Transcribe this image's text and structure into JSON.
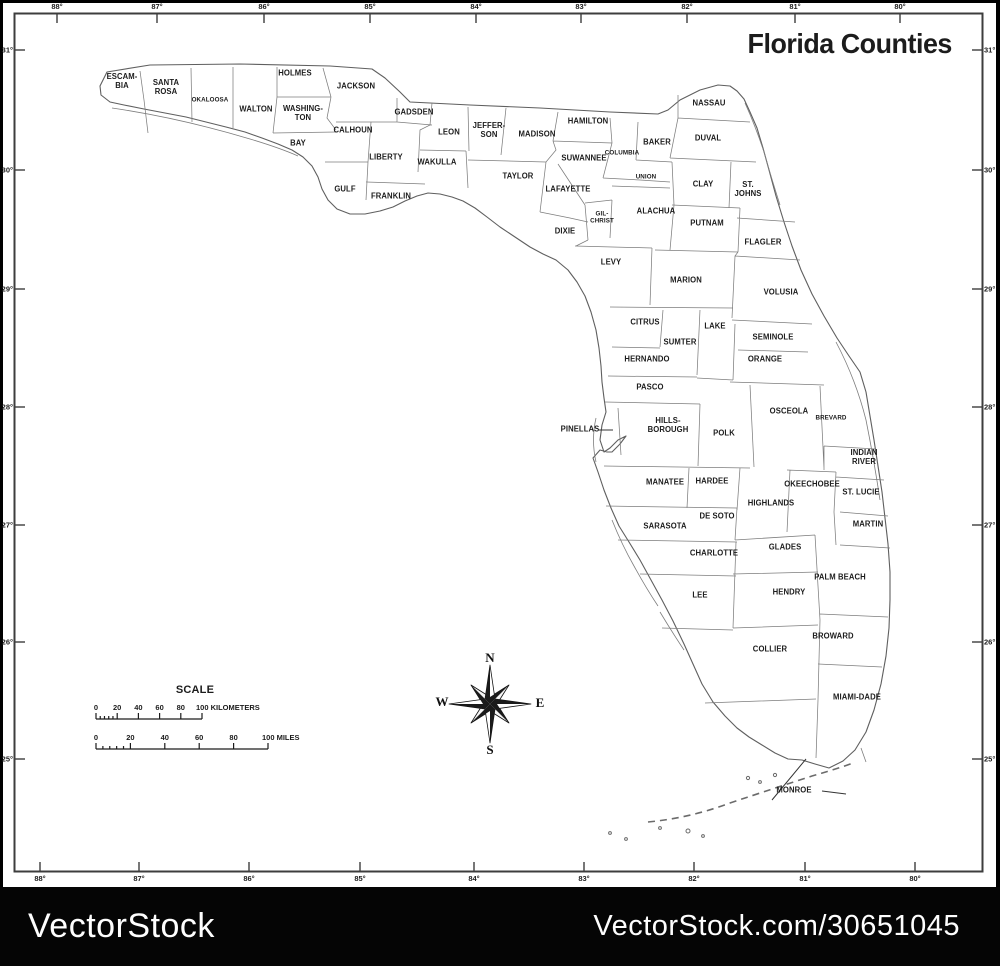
{
  "title": "Florida Counties",
  "map": {
    "counties": [
      {
        "name": "ESCAM-\nBIA",
        "x": 122,
        "y": 82
      },
      {
        "name": "SANTA\nROSA",
        "x": 166,
        "y": 88
      },
      {
        "name": "OKALOOSA",
        "x": 210,
        "y": 100,
        "small": true
      },
      {
        "name": "HOLMES",
        "x": 295,
        "y": 74
      },
      {
        "name": "WALTON",
        "x": 256,
        "y": 110
      },
      {
        "name": "WASHING-\nTON",
        "x": 303,
        "y": 114
      },
      {
        "name": "JACKSON",
        "x": 356,
        "y": 87
      },
      {
        "name": "BAY",
        "x": 298,
        "y": 144
      },
      {
        "name": "CALHOUN",
        "x": 353,
        "y": 131
      },
      {
        "name": "GADSDEN",
        "x": 414,
        "y": 113
      },
      {
        "name": "LIBERTY",
        "x": 386,
        "y": 158
      },
      {
        "name": "GULF",
        "x": 345,
        "y": 190
      },
      {
        "name": "FRANKLIN",
        "x": 391,
        "y": 197
      },
      {
        "name": "LEON",
        "x": 449,
        "y": 133
      },
      {
        "name": "JEFFER-\nSON",
        "x": 489,
        "y": 131
      },
      {
        "name": "WAKULLA",
        "x": 437,
        "y": 163
      },
      {
        "name": "MADISON",
        "x": 537,
        "y": 135
      },
      {
        "name": "TAYLOR",
        "x": 518,
        "y": 177
      },
      {
        "name": "LAFAYETTE",
        "x": 568,
        "y": 190
      },
      {
        "name": "HAMILTON",
        "x": 588,
        "y": 122
      },
      {
        "name": "SUWANNEE",
        "x": 584,
        "y": 159
      },
      {
        "name": "COLUMBIA",
        "x": 622,
        "y": 153,
        "small": true
      },
      {
        "name": "UNION",
        "x": 646,
        "y": 177,
        "small": true
      },
      {
        "name": "BAKER",
        "x": 657,
        "y": 143
      },
      {
        "name": "NASSAU",
        "x": 709,
        "y": 104
      },
      {
        "name": "DUVAL",
        "x": 708,
        "y": 139
      },
      {
        "name": "CLAY",
        "x": 703,
        "y": 185
      },
      {
        "name": "ST.\nJOHNS",
        "x": 748,
        "y": 190
      },
      {
        "name": "GIL-\nCHRIST",
        "x": 602,
        "y": 218,
        "small": true
      },
      {
        "name": "ALACHUA",
        "x": 656,
        "y": 212
      },
      {
        "name": "PUTNAM",
        "x": 707,
        "y": 224
      },
      {
        "name": "DIXIE",
        "x": 565,
        "y": 232
      },
      {
        "name": "FLAGLER",
        "x": 763,
        "y": 243
      },
      {
        "name": "LEVY",
        "x": 611,
        "y": 263
      },
      {
        "name": "MARION",
        "x": 686,
        "y": 281
      },
      {
        "name": "VOLUSIA",
        "x": 781,
        "y": 293
      },
      {
        "name": "CITRUS",
        "x": 645,
        "y": 323
      },
      {
        "name": "LAKE",
        "x": 715,
        "y": 327
      },
      {
        "name": "SUMTER",
        "x": 680,
        "y": 343
      },
      {
        "name": "SEMINOLE",
        "x": 773,
        "y": 338
      },
      {
        "name": "HERNANDO",
        "x": 647,
        "y": 360
      },
      {
        "name": "ORANGE",
        "x": 765,
        "y": 360
      },
      {
        "name": "PASCO",
        "x": 650,
        "y": 388
      },
      {
        "name": "OSCEOLA",
        "x": 789,
        "y": 412
      },
      {
        "name": "BREVARD",
        "x": 831,
        "y": 418,
        "small": true
      },
      {
        "name": "PINELLAS",
        "x": 580,
        "y": 430
      },
      {
        "name": "HILLS-\nBOROUGH",
        "x": 668,
        "y": 426
      },
      {
        "name": "POLK",
        "x": 724,
        "y": 434
      },
      {
        "name": "INDIAN\nRIVER",
        "x": 864,
        "y": 458
      },
      {
        "name": "MANATEE",
        "x": 665,
        "y": 483
      },
      {
        "name": "HARDEE",
        "x": 712,
        "y": 482
      },
      {
        "name": "OKEECHOBEE",
        "x": 812,
        "y": 485
      },
      {
        "name": "ST. LUCIE",
        "x": 861,
        "y": 493
      },
      {
        "name": "HIGHLANDS",
        "x": 771,
        "y": 504
      },
      {
        "name": "DE SOTO",
        "x": 717,
        "y": 517
      },
      {
        "name": "SARASOTA",
        "x": 665,
        "y": 527
      },
      {
        "name": "MARTIN",
        "x": 868,
        "y": 525
      },
      {
        "name": "CHARLOTTE",
        "x": 714,
        "y": 554
      },
      {
        "name": "GLADES",
        "x": 785,
        "y": 548
      },
      {
        "name": "PALM BEACH",
        "x": 840,
        "y": 578
      },
      {
        "name": "LEE",
        "x": 700,
        "y": 596
      },
      {
        "name": "HENDRY",
        "x": 789,
        "y": 593
      },
      {
        "name": "BROWARD",
        "x": 833,
        "y": 637
      },
      {
        "name": "COLLIER",
        "x": 770,
        "y": 650
      },
      {
        "name": "MIAMI-DADE",
        "x": 857,
        "y": 698
      },
      {
        "name": "MONROE",
        "x": 794,
        "y": 791
      }
    ]
  },
  "graticule": {
    "top_longitudes": [
      "88°",
      "87°",
      "86°",
      "85°",
      "84°",
      "83°",
      "82°",
      "81°",
      "80°"
    ],
    "bottom_longitudes": [
      "88°",
      "87°",
      "86°",
      "85°",
      "84°",
      "83°",
      "82°",
      "81°",
      "80°"
    ],
    "left_latitudes": [
      "31°",
      "30°",
      "29°",
      "28°",
      "27°",
      "26°",
      "25°"
    ],
    "right_latitudes": [
      "31°",
      "30°",
      "29°",
      "28°",
      "27°",
      "26°",
      "25°"
    ]
  },
  "scale": {
    "heading": "SCALE",
    "km": {
      "tick_labels": [
        "0",
        "20",
        "40",
        "60",
        "80"
      ],
      "end_label": "100 KILOMETERS"
    },
    "miles": {
      "tick_labels": [
        "0",
        "20",
        "40",
        "60",
        "80"
      ],
      "end_label": "100 MILES"
    }
  },
  "compass": {
    "north": "N",
    "east": "E",
    "south": "S",
    "west": "W"
  },
  "watermark": {
    "brand": "VectorStock",
    "credit": "VectorStock.com/30651045"
  }
}
